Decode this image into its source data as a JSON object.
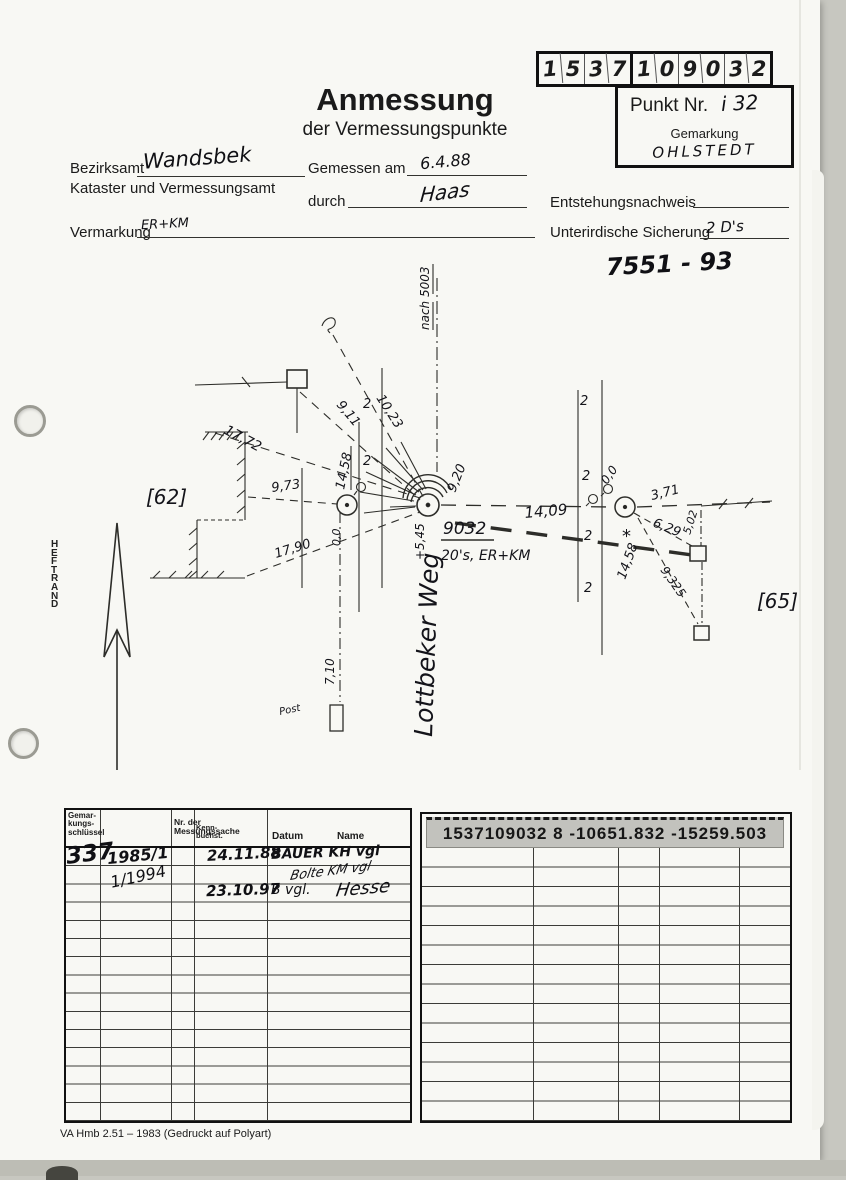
{
  "header": {
    "code_digits": [
      "1",
      "5",
      "3",
      "7",
      "1",
      "0",
      "9",
      "0",
      "3",
      "2"
    ],
    "punkt_label": "Punkt Nr.",
    "punkt_value": "i 32",
    "gemarkung_label": "Gemarkung",
    "gemarkung_value": "OHLSTEDT",
    "title": "Anmessung",
    "subtitle": "der Vermessungspunkte",
    "bezirksamt_label": "Bezirksamt",
    "bezirksamt_value": "Wandsbek",
    "kataster_label": "Kataster und Vermessungsamt",
    "gemessen_label": "Gemessen am",
    "gemessen_value": "6.4.88",
    "durch_label": "durch",
    "durch_value": "Haas",
    "vermarkung_label": "Vermarkung",
    "vermarkung_value": "ER+KM",
    "entstehung_label": "Entstehungsnachweis",
    "sicherung_label": "Unterirdische Sicherung",
    "sicherung_value": "2 D's",
    "file_number": "7551 - 93"
  },
  "sketch": {
    "heftrand": "H\nE\nF\nT\nR\nA\nN\nD",
    "ref_left": "[62]",
    "ref_right": "[65]",
    "street": "Lottbeker Weg",
    "nach": "nach 5003",
    "post": "Post",
    "marker": "2",
    "asterisk": "*",
    "point_center": {
      "id": "9032",
      "note": "20's, ER+KM",
      "offset": "+5,45",
      "arc": "9,20"
    },
    "measures": {
      "d10_23": "10,23",
      "d9_11": "9,11",
      "d17_72": "17,72",
      "d14_58l": "14,58",
      "d9_73": "9,73",
      "d17_90": "17,90",
      "d7_10": "7,10",
      "d14_09": "14,09",
      "d0_0l": "0,0",
      "d0_0r": "0,0",
      "d3_71": "3,71",
      "d6_29": "6,29",
      "d5_02": "5,02",
      "d14_58r": "14,58",
      "d9_325": "9,325"
    }
  },
  "left_table": {
    "headers": [
      "Gemar-\nkungs-\nschlüssel",
      "Nr. der\nMessungssache",
      "Kenn-\nbuchst.",
      "Datum",
      "Name"
    ],
    "entries": {
      "schluessel": "337",
      "sache1": "1985/1",
      "sache2": "1/1994",
      "datum1": "24.11.88",
      "name1": "BAUER KH vgl",
      "sig": "Bolte KM vgl",
      "datum2": "23.10.97",
      "name2": "B vgl.",
      "name2_sig": "Hesse"
    }
  },
  "right_table": {
    "sticker": "1537109032 8  -10651.832 -15259.503"
  },
  "footer": "VA Hmb 2.51 – 1983 (Gedruckt auf Polyart)"
}
